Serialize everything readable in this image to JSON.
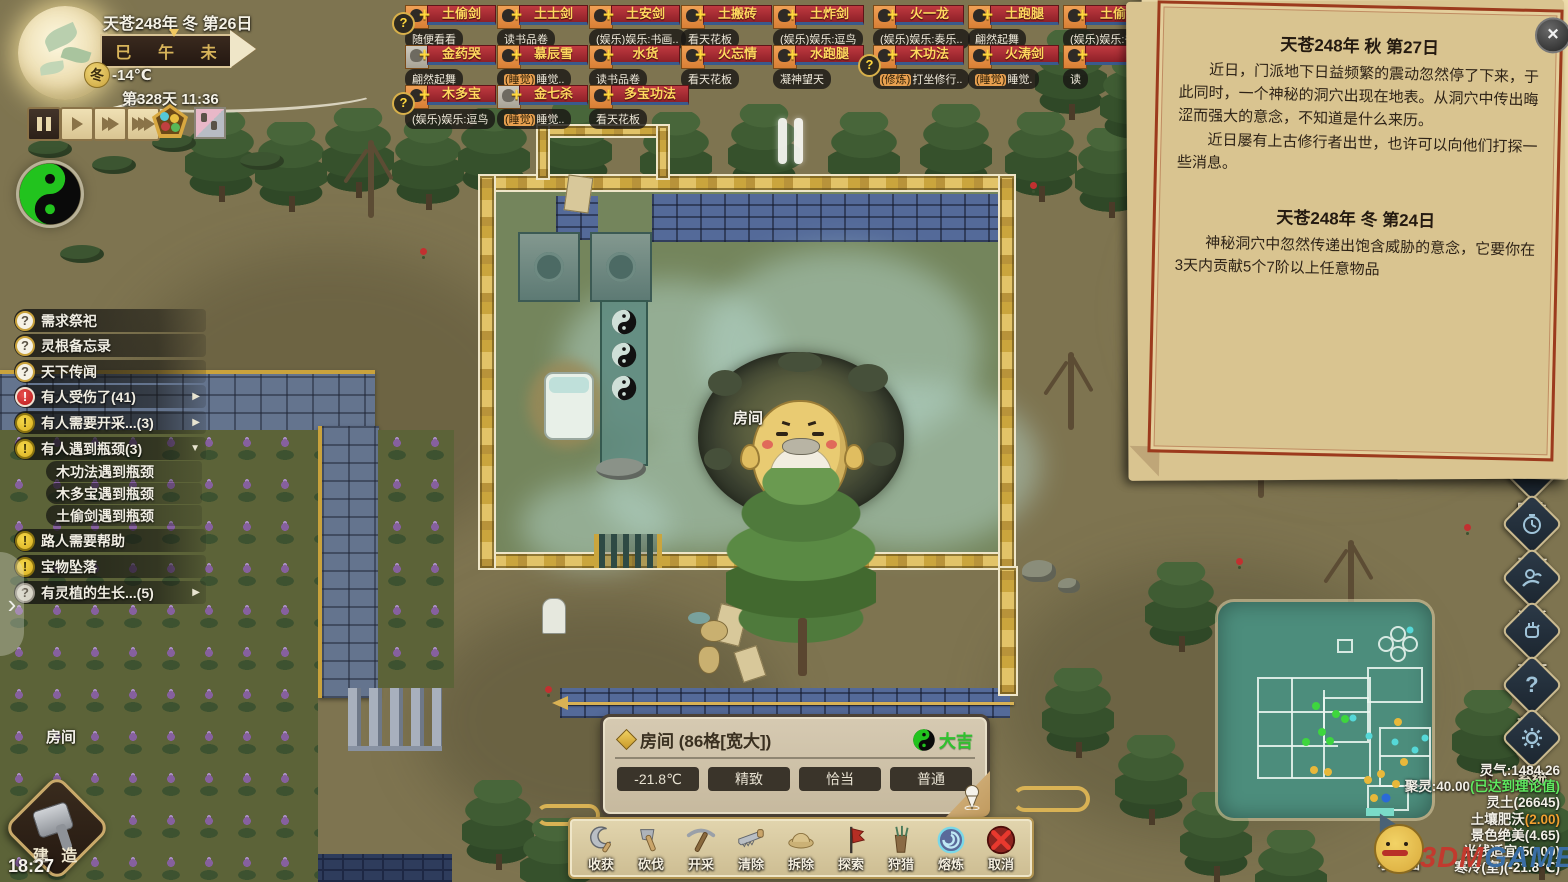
{
  "colors": {
    "accent_gold": "#c9a23c",
    "luck_green": "#2ec32e",
    "alert_red": "#d42a2a",
    "alert_yellow": "#e8c832",
    "name_plate": "#b03038"
  },
  "hud": {
    "date": "天苍248年 冬 第26日",
    "day_counter": "第328天 11:36",
    "season_badge": "冬",
    "outdoor_temp": "-14℃",
    "time_slots": [
      "巳",
      "午",
      "未"
    ],
    "clock": "18:27",
    "map_label": "小地图"
  },
  "world": {
    "room_floating_label": "房间",
    "cave_room_label": "房间"
  },
  "characters": {
    "rows": [
      {
        "cards": [
          {
            "name": "土偷剑",
            "status_tag": "",
            "status_rest": "随便看看"
          },
          {
            "name": "土士剑",
            "status_tag": "",
            "status_rest": "读书品卷"
          },
          {
            "name": "土安剑",
            "status_tag": "",
            "status_rest": "(娱乐)娱乐:书画.."
          },
          {
            "name": "土搬砖",
            "status_tag": "",
            "status_rest": "看天花板"
          },
          {
            "name": "土炸剑",
            "status_tag": "",
            "status_rest": "(娱乐)娱乐:逗鸟"
          },
          {
            "name": "火一龙",
            "status_tag": "",
            "status_rest": "(娱乐)娱乐:奏乐.."
          },
          {
            "name": "土跑腿",
            "status_tag": "",
            "status_rest": "翩然起舞"
          },
          {
            "name": "土偷一",
            "status_tag": "",
            "status_rest": "(娱乐)娱乐:书画"
          }
        ]
      },
      {
        "cards": [
          {
            "name": "金药哭",
            "status_tag": "",
            "status_rest": "翩然起舞"
          },
          {
            "name": "慕辰雪",
            "status_tag": "(睡觉)",
            "status_rest": "睡觉.."
          },
          {
            "name": "水货",
            "status_tag": "",
            "status_rest": "读书品卷"
          },
          {
            "name": "火忘情",
            "status_tag": "",
            "status_rest": "看天花板"
          },
          {
            "name": "水跑腿",
            "status_tag": "",
            "status_rest": "凝神望天"
          },
          {
            "name": "木功法",
            "status_tag": "(修炼)",
            "status_rest": "打坐修行.."
          },
          {
            "name": "火涛剑",
            "status_tag": "(睡觉)",
            "status_rest": "睡觉."
          },
          {
            "name": "",
            "status_tag": "",
            "status_rest": "读"
          }
        ]
      },
      {
        "cards": [
          {
            "name": "木多宝",
            "status_tag": "",
            "status_rest": "(娱乐)娱乐:逗鸟"
          },
          {
            "name": "金七杀",
            "status_tag": "(睡觉)",
            "status_rest": "睡觉.."
          },
          {
            "name": "多宝功法",
            "status_tag": "",
            "status_rest": "看天花板"
          }
        ]
      }
    ]
  },
  "alerts": [
    {
      "label": "需求祭祀",
      "arrow": ""
    },
    {
      "label": "灵根备忘录",
      "arrow": ""
    },
    {
      "label": "天下传闻",
      "arrow": ""
    },
    {
      "label": "有人受伤了(41)",
      "arrow": "▶"
    },
    {
      "label": "有人需要开采...(3)",
      "arrow": "▶"
    },
    {
      "label": "有人遇到瓶颈(3)",
      "arrow": "▼"
    },
    {
      "label": "木功法遇到瓶颈",
      "arrow": ""
    },
    {
      "label": "木多宝遇到瓶颈",
      "arrow": ""
    },
    {
      "label": "土偷剑遇到瓶颈",
      "arrow": ""
    },
    {
      "label": "路人需要帮助",
      "arrow": ""
    },
    {
      "label": "宝物坠落",
      "arrow": ""
    },
    {
      "label": "有灵植的生长...(5)",
      "arrow": "▶"
    }
  ],
  "events": {
    "close_glyph": "×",
    "e1": {
      "title": "天苍248年 秋 第27日",
      "p1": "近日，门派地下日益频繁的震动忽然停了下来，于此同时，一个神秘的洞穴出现在地表。从洞穴中传出晦涩而强大的意念，不知道是什么来历。",
      "p2": "近日屡有上古修行者出世，也许可以向他们打探一些消息。"
    },
    "e2": {
      "title": "天苍248年 冬 第24日",
      "p1": "神秘洞穴中忽然传递出饱含威胁的意念，它要你在3天内贡献5个7阶以上任意物品"
    }
  },
  "selection": {
    "title": "房间 (86格[宽大])",
    "luck": "大吉",
    "badges": [
      "-21.8℃",
      "精致",
      "恰当",
      "普通"
    ]
  },
  "toolbar": {
    "tools": [
      {
        "label": "收获"
      },
      {
        "label": "砍伐"
      },
      {
        "label": "开采"
      },
      {
        "label": "清除"
      },
      {
        "label": "拆除"
      },
      {
        "label": "探索"
      },
      {
        "label": "狩猎"
      },
      {
        "label": "熔炼"
      },
      {
        "label": "取消"
      }
    ]
  },
  "side_menu": {
    "items": [
      {
        "label": "阵法"
      },
      {
        "label": "工作"
      },
      {
        "label": "门派"
      },
      {
        "label": "天下"
      },
      {
        "label": "帮助"
      },
      {
        "label": "系统"
      }
    ]
  },
  "stats": {
    "lines": [
      {
        "main": "灵气:1484.26",
        "suffix": ""
      },
      {
        "main": "聚灵:40.00",
        "suffix": "(已达到理论值)"
      },
      {
        "main": "灵土(26645)",
        "suffix": ""
      },
      {
        "main": "土壤肥沃",
        "suffix": "(2.00)"
      },
      {
        "main": "景色绝美(4.65)",
        "suffix": ""
      },
      {
        "main": "光线适宜(50.00)",
        "suffix": ""
      },
      {
        "main": "寒冷(室)(-21.8℃)",
        "suffix": ""
      }
    ]
  },
  "build": {
    "label": "建 造"
  },
  "watermark": {
    "red": "3DM",
    "blue": "GAME"
  }
}
